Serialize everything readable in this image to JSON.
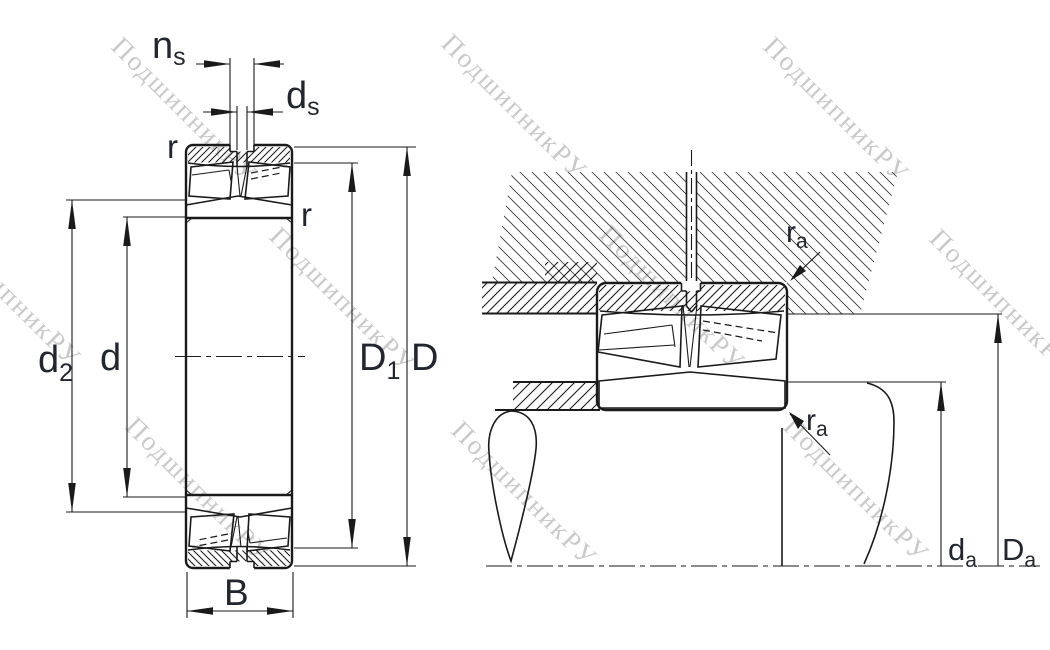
{
  "drawing": {
    "type": "bearing-dimension-drawing",
    "views": [
      "bearing-cross-section",
      "mounted-arrangement"
    ]
  },
  "watermark": {
    "text": "ПодшипникРУ"
  },
  "labels": {
    "ns_base": "n",
    "ns_sub": "s",
    "ds_base": "d",
    "ds_sub": "s",
    "r_outer": "r",
    "r_inner": "r",
    "d2_base": "d",
    "d2_sub": "2",
    "d": "d",
    "D1_base": "D",
    "D1_sub": "1",
    "D": "D",
    "B": "B",
    "ra_top_base": "r",
    "ra_top_sub": "a",
    "ra_bottom_base": "r",
    "ra_bottom_sub": "a",
    "da_base": "d",
    "da_sub": "a",
    "Da_base": "D",
    "Da_sub": "a"
  },
  "colors": {
    "line": "#1a1a1a",
    "label": "#23262e",
    "hatch_fine": "#3f3f3f",
    "watermark": "#b7b7b7",
    "background": "#ffffff"
  }
}
